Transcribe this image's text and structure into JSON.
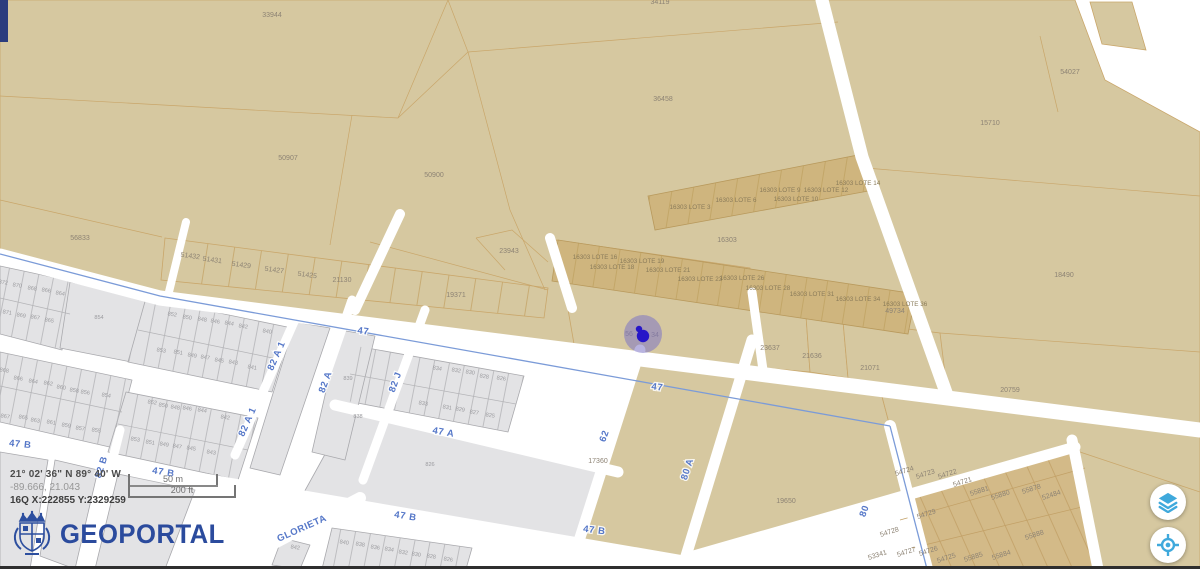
{
  "branding": {
    "name": "GEOPORTAL"
  },
  "coordinates": {
    "dms": "21° 02' 36\" N 89° 40' W",
    "decimal": "-89.666, 21.043",
    "utm": "16Q X:222855 Y:2329259"
  },
  "scale_bar": {
    "metric": "50 m",
    "imperial": "200 ft"
  },
  "controls": {
    "buttons": [
      {
        "icon": "layers",
        "name": "layers-button"
      },
      {
        "icon": "locate",
        "name": "locate-button"
      }
    ]
  },
  "colors": {
    "parcel_tan": "#d6c8a0",
    "parcel_tan_dark": "#cfb57e",
    "parcel_block_tan": "#d3ba88",
    "parcel_gray": "#e3e3e5",
    "street_white": "#ffffff",
    "street_label_blue": "#5577c8",
    "road_line_blue": "#7b9bd8",
    "brand_blue": "#2b4b9d",
    "control_icon_blue": "#3fa9dc",
    "navy_bar": "#2b3c7e",
    "marker_halo": "#7d74c4",
    "marker_dot": "#2616c8"
  },
  "map": {
    "street_labels": [
      {
        "t": "47",
        "x": 363,
        "y": 334,
        "r": 7
      },
      {
        "t": "47",
        "x": 657,
        "y": 390,
        "r": 7
      },
      {
        "t": "47 A",
        "x": 443,
        "y": 435,
        "r": 10
      },
      {
        "t": "47 B",
        "x": 20,
        "y": 447,
        "r": 6
      },
      {
        "t": "47 B",
        "x": 163,
        "y": 475,
        "r": 9
      },
      {
        "t": "47 B",
        "x": 405,
        "y": 519,
        "r": 9
      },
      {
        "t": "47 B",
        "x": 594,
        "y": 533,
        "r": 7
      },
      {
        "t": "62",
        "x": 607,
        "y": 437,
        "r": -70
      },
      {
        "t": "80 A",
        "x": 690,
        "y": 470,
        "r": -72
      },
      {
        "t": "80",
        "x": 867,
        "y": 512,
        "r": -70
      },
      {
        "t": "82 A",
        "x": 328,
        "y": 383,
        "r": -70
      },
      {
        "t": "82 A 1",
        "x": 279,
        "y": 357,
        "r": -66
      },
      {
        "t": "82 A 1",
        "x": 250,
        "y": 423,
        "r": -66
      },
      {
        "t": "82 B",
        "x": 104,
        "y": 468,
        "r": -72
      },
      {
        "t": "82 J",
        "x": 398,
        "y": 383,
        "r": -70
      },
      {
        "t": "GLORIETA",
        "x": 303,
        "y": 531,
        "r": -24
      }
    ],
    "parcels_tan": [
      {
        "t": "33944",
        "x": 272,
        "y": 17
      },
      {
        "t": "34119",
        "x": 660,
        "y": 4
      },
      {
        "t": "36458",
        "x": 663,
        "y": 101
      },
      {
        "t": "50907",
        "x": 288,
        "y": 160
      },
      {
        "t": "50900",
        "x": 434,
        "y": 177
      },
      {
        "t": "54027",
        "x": 1070,
        "y": 74
      },
      {
        "t": "15710",
        "x": 990,
        "y": 125
      },
      {
        "t": "56833",
        "x": 80,
        "y": 240
      },
      {
        "t": "51432",
        "x": 190,
        "y": 258,
        "r": 8
      },
      {
        "t": "51431",
        "x": 212,
        "y": 262,
        "r": 8
      },
      {
        "t": "51429",
        "x": 241,
        "y": 267,
        "r": 8
      },
      {
        "t": "51427",
        "x": 274,
        "y": 272,
        "r": 8
      },
      {
        "t": "51425",
        "x": 307,
        "y": 277,
        "r": 8
      },
      {
        "t": "21130",
        "x": 342,
        "y": 282
      },
      {
        "t": "23943",
        "x": 509,
        "y": 253
      },
      {
        "t": "19371",
        "x": 456,
        "y": 297
      },
      {
        "t": "16303",
        "x": 727,
        "y": 242
      },
      {
        "t": "18490",
        "x": 1064,
        "y": 277
      },
      {
        "t": "49734",
        "x": 895,
        "y": 313
      },
      {
        "t": "23637",
        "x": 770,
        "y": 350
      },
      {
        "t": "21636",
        "x": 812,
        "y": 358
      },
      {
        "t": "21071",
        "x": 870,
        "y": 370
      },
      {
        "t": "20759",
        "x": 1010,
        "y": 392
      },
      {
        "t": "17360",
        "x": 598,
        "y": 463
      },
      {
        "t": "19650",
        "x": 786,
        "y": 503
      },
      {
        "t": "56",
        "x": 629,
        "y": 336
      },
      {
        "t": "34",
        "x": 655,
        "y": 337
      },
      {
        "t": "54724",
        "x": 905,
        "y": 473,
        "r": -18
      },
      {
        "t": "54723",
        "x": 926,
        "y": 476,
        "r": -18
      },
      {
        "t": "54722",
        "x": 948,
        "y": 476,
        "r": -18
      },
      {
        "t": "54721",
        "x": 963,
        "y": 484,
        "r": -18
      },
      {
        "t": "55881",
        "x": 980,
        "y": 493,
        "r": -18
      },
      {
        "t": "55880",
        "x": 1001,
        "y": 497,
        "r": -18
      },
      {
        "t": "55878",
        "x": 1032,
        "y": 491,
        "r": -18
      },
      {
        "t": "52484",
        "x": 1052,
        "y": 497,
        "r": -18
      },
      {
        "t": "54729",
        "x": 927,
        "y": 516,
        "r": -18
      },
      {
        "t": "54728",
        "x": 890,
        "y": 534,
        "r": -18
      },
      {
        "t": "53341",
        "x": 878,
        "y": 557,
        "r": -18
      },
      {
        "t": "54727",
        "x": 907,
        "y": 554,
        "r": -18
      },
      {
        "t": "54726",
        "x": 929,
        "y": 553,
        "r": -18
      },
      {
        "t": "54725",
        "x": 947,
        "y": 560,
        "r": -18
      },
      {
        "t": "55885",
        "x": 974,
        "y": 559,
        "r": -18
      },
      {
        "t": "55884",
        "x": 1002,
        "y": 557,
        "r": -18
      },
      {
        "t": "55888",
        "x": 1035,
        "y": 537,
        "r": -18
      }
    ],
    "parcels_lote": [
      {
        "t": "16303 LOTE 3",
        "x": 690,
        "y": 209
      },
      {
        "t": "16303 LOTE 6",
        "x": 736,
        "y": 202
      },
      {
        "t": "16303 LOTE 9",
        "x": 780,
        "y": 192
      },
      {
        "t": "16303 LOTE 10",
        "x": 796,
        "y": 201
      },
      {
        "t": "16303 LOTE 12",
        "x": 826,
        "y": 192
      },
      {
        "t": "16303 LOTE 14",
        "x": 858,
        "y": 185
      },
      {
        "t": "16303 LOTE 16",
        "x": 595,
        "y": 259
      },
      {
        "t": "16303 LOTE 19",
        "x": 642,
        "y": 263
      },
      {
        "t": "16303 LOTE 18",
        "x": 612,
        "y": 269
      },
      {
        "t": "16303 LOTE 21",
        "x": 668,
        "y": 272
      },
      {
        "t": "16303 LOTE 23",
        "x": 700,
        "y": 281
      },
      {
        "t": "16303 LOTE 26",
        "x": 742,
        "y": 280
      },
      {
        "t": "16303 LOTE 28",
        "x": 768,
        "y": 290
      },
      {
        "t": "16303 LOTE 31",
        "x": 812,
        "y": 296
      },
      {
        "t": "16303 LOTE 34",
        "x": 858,
        "y": 301
      },
      {
        "t": "16303 LOTE 36",
        "x": 905,
        "y": 306
      }
    ],
    "parcels_gray": [
      {
        "t": "872",
        "x": 3,
        "y": 284,
        "r": 10
      },
      {
        "t": "870",
        "x": 17,
        "y": 287,
        "r": 10
      },
      {
        "t": "868",
        "x": 32,
        "y": 290,
        "r": 10
      },
      {
        "t": "866",
        "x": 46,
        "y": 292,
        "r": 10
      },
      {
        "t": "864",
        "x": 60,
        "y": 295,
        "r": 10
      },
      {
        "t": "871",
        "x": 7,
        "y": 314,
        "r": 10
      },
      {
        "t": "869",
        "x": 21,
        "y": 317,
        "r": 10
      },
      {
        "t": "867",
        "x": 35,
        "y": 319,
        "r": 10
      },
      {
        "t": "865",
        "x": 49,
        "y": 322,
        "r": 10
      },
      {
        "t": "854",
        "x": 99,
        "y": 319
      },
      {
        "t": "852",
        "x": 172,
        "y": 316,
        "r": 10
      },
      {
        "t": "850",
        "x": 187,
        "y": 319,
        "r": 10
      },
      {
        "t": "848",
        "x": 202,
        "y": 321,
        "r": 10
      },
      {
        "t": "846",
        "x": 215,
        "y": 323,
        "r": 10
      },
      {
        "t": "844",
        "x": 229,
        "y": 325,
        "r": 10
      },
      {
        "t": "842",
        "x": 243,
        "y": 328,
        "r": 10
      },
      {
        "t": "840",
        "x": 267,
        "y": 333,
        "r": 10
      },
      {
        "t": "853",
        "x": 161,
        "y": 352,
        "r": 10
      },
      {
        "t": "851",
        "x": 178,
        "y": 354,
        "r": 10
      },
      {
        "t": "849",
        "x": 192,
        "y": 357,
        "r": 10
      },
      {
        "t": "847",
        "x": 205,
        "y": 359,
        "r": 10
      },
      {
        "t": "845",
        "x": 219,
        "y": 362,
        "r": 10
      },
      {
        "t": "843",
        "x": 233,
        "y": 364,
        "r": 10
      },
      {
        "t": "841",
        "x": 252,
        "y": 369,
        "r": 10
      },
      {
        "t": "868",
        "x": 4,
        "y": 372,
        "r": 10
      },
      {
        "t": "866",
        "x": 18,
        "y": 380,
        "r": 10
      },
      {
        "t": "864",
        "x": 33,
        "y": 383,
        "r": 10
      },
      {
        "t": "862",
        "x": 48,
        "y": 385,
        "r": 10
      },
      {
        "t": "860",
        "x": 61,
        "y": 389,
        "r": 10
      },
      {
        "t": "858",
        "x": 74,
        "y": 392,
        "r": 10
      },
      {
        "t": "856",
        "x": 85,
        "y": 394,
        "r": 10
      },
      {
        "t": "854",
        "x": 106,
        "y": 397,
        "r": 10
      },
      {
        "t": "867",
        "x": 5,
        "y": 418,
        "r": 10
      },
      {
        "t": "865",
        "x": 23,
        "y": 419,
        "r": 10
      },
      {
        "t": "863",
        "x": 35,
        "y": 422,
        "r": 10
      },
      {
        "t": "861",
        "x": 51,
        "y": 424,
        "r": 10
      },
      {
        "t": "859",
        "x": 66,
        "y": 427,
        "r": 10
      },
      {
        "t": "857",
        "x": 80,
        "y": 430,
        "r": 10
      },
      {
        "t": "855",
        "x": 96,
        "y": 432,
        "r": 10
      },
      {
        "t": "852",
        "x": 152,
        "y": 404,
        "r": 10
      },
      {
        "t": "850",
        "x": 163,
        "y": 407,
        "r": 10
      },
      {
        "t": "848",
        "x": 175,
        "y": 409,
        "r": 10
      },
      {
        "t": "846",
        "x": 187,
        "y": 410,
        "r": 10
      },
      {
        "t": "844",
        "x": 202,
        "y": 412,
        "r": 10
      },
      {
        "t": "842",
        "x": 225,
        "y": 419,
        "r": 10
      },
      {
        "t": "853",
        "x": 135,
        "y": 441,
        "r": 10
      },
      {
        "t": "851",
        "x": 150,
        "y": 444,
        "r": 10
      },
      {
        "t": "849",
        "x": 164,
        "y": 446,
        "r": 10
      },
      {
        "t": "847",
        "x": 177,
        "y": 448,
        "r": 10
      },
      {
        "t": "845",
        "x": 191,
        "y": 450,
        "r": 10
      },
      {
        "t": "843",
        "x": 211,
        "y": 454,
        "r": 10
      },
      {
        "t": "839",
        "x": 348,
        "y": 380
      },
      {
        "t": "838",
        "x": 358,
        "y": 418
      },
      {
        "t": "834",
        "x": 437,
        "y": 370,
        "r": 10
      },
      {
        "t": "832",
        "x": 456,
        "y": 372,
        "r": 10
      },
      {
        "t": "830",
        "x": 470,
        "y": 374,
        "r": 10
      },
      {
        "t": "828",
        "x": 484,
        "y": 378,
        "r": 10
      },
      {
        "t": "826",
        "x": 501,
        "y": 380,
        "r": 10
      },
      {
        "t": "833",
        "x": 423,
        "y": 405,
        "r": 10
      },
      {
        "t": "831",
        "x": 447,
        "y": 409,
        "r": 10
      },
      {
        "t": "829",
        "x": 460,
        "y": 411,
        "r": 10
      },
      {
        "t": "827",
        "x": 474,
        "y": 414,
        "r": 10
      },
      {
        "t": "825",
        "x": 490,
        "y": 417,
        "r": 10
      },
      {
        "t": "826",
        "x": 430,
        "y": 466
      },
      {
        "t": "842",
        "x": 295,
        "y": 549,
        "r": 10
      },
      {
        "t": "840",
        "x": 344,
        "y": 544,
        "r": 10
      },
      {
        "t": "838",
        "x": 360,
        "y": 546,
        "r": 10
      },
      {
        "t": "836",
        "x": 375,
        "y": 549,
        "r": 10
      },
      {
        "t": "834",
        "x": 389,
        "y": 551,
        "r": 10
      },
      {
        "t": "832",
        "x": 403,
        "y": 554,
        "r": 10
      },
      {
        "t": "830",
        "x": 416,
        "y": 556,
        "r": 10
      },
      {
        "t": "828",
        "x": 431,
        "y": 558,
        "r": 10
      },
      {
        "t": "826",
        "x": 448,
        "y": 561,
        "r": 10
      }
    ]
  }
}
